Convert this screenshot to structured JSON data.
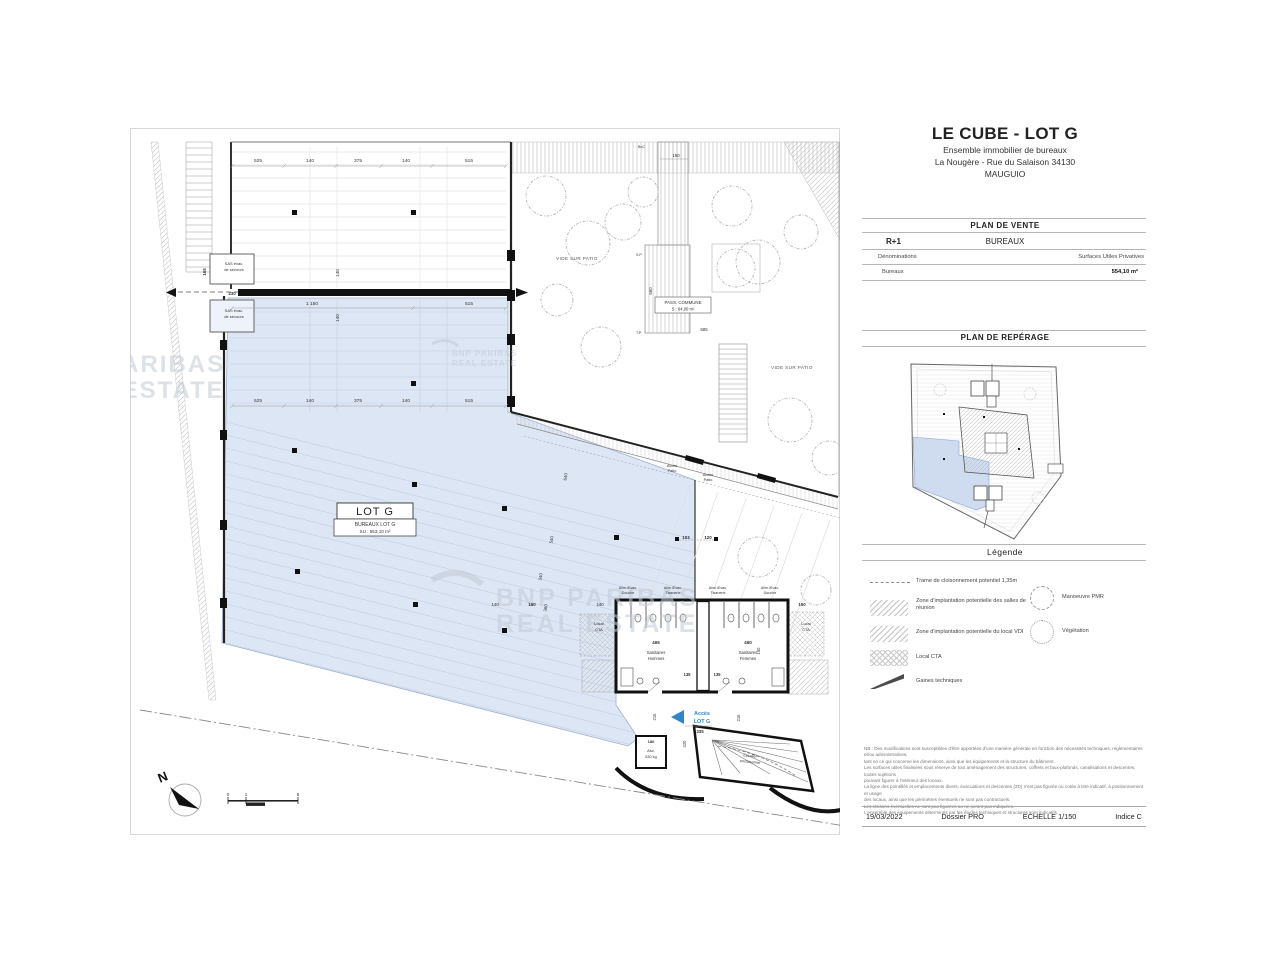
{
  "header": {
    "title": "LE CUBE - LOT G",
    "line1": "Ensemble immobilier de bureaux",
    "line2": "La Nougère - Rue du Salaison 34130",
    "line3": "MAUGUIO"
  },
  "vente": {
    "title": "PLAN DE VENTE",
    "level": "R+1",
    "usage": "BUREAUX",
    "col_name": "Dénominations",
    "col_surface": "Surfaces Utiles Privatives",
    "row_name": "Bureaux",
    "row_surface": "554,10 m²"
  },
  "reperage": {
    "title": "PLAN DE REPÉRAGE"
  },
  "legende": {
    "title": "Légende",
    "item1": "Trame de cloisonnement potentiel 1,35m",
    "item2": "Zone d'implantation potentielle des salles de réunion",
    "item3": "Zone d'implantation potentielle du local VDI",
    "item4": "Local CTA",
    "item5": "Gaines techniques",
    "pmr": "Manoeuvre PMR",
    "vegetation": "Végétation"
  },
  "disclaimer": [
    "NB : Des modifications sont susceptibles d'être apportées d'une manière générale en fonction des nécessités techniques, réglementaires et/ou administratives,",
    "tant en ce qui concerne les dimensions, ainsi que les équipements et la structure du bâtiment.",
    "Les surfaces utiles finalisées sous réserve de tout aménagement des structures, coffrets et faux-plafonds, canalisations et descentes, toutes sujétions",
    "pouvant figurer à l'intérieur des locaux.",
    "La ligne des pointillés et emplacements divers, évacuations et descentes (2D) n'est pas figurée ou cotée à titre indicatif, à positionnement et usage",
    "des locaux, ainsi que les périmètres éventuels ne sont pas contractuels.",
    "Les cloisons éventuelles ne sont pas figurées ou ne seront pas indiquées.",
    "L'ensemble des équipements déterminés par les études techniques et structures sont indicatifs."
  ],
  "footer": {
    "date": "19/03/2022",
    "dossier": "Dossier PRO",
    "echelle": "ECHELLE 1/150",
    "indice": "Indice C"
  },
  "plan": {
    "lot_box": {
      "title": "LOT G",
      "subtitle": "BUREAUX LOT G",
      "surface": "SU : 553,10 m²"
    },
    "dims": {
      "top": [
        "525",
        "140",
        "375",
        "140",
        "515"
      ],
      "mid": [
        "525",
        "140",
        "375",
        "140",
        "515"
      ],
      "wall": [
        "1 150",
        "515"
      ],
      "v140a": "140",
      "v140b": "140",
      "sas_w": "230",
      "sas_h": "165",
      "pass_w": "190",
      "pass_h": "660",
      "pass_b": "685",
      "inner": [
        "640",
        "540",
        "340",
        "360"
      ],
      "door_a": "103",
      "door_b": "120",
      "wc_top": [
        "140",
        "160",
        "140",
        "150"
      ],
      "wc_135a": "135",
      "wc_135b": "135",
      "wc_150": "150",
      "e216a": "216",
      "e216b": "216",
      "e335": "335",
      "e420": "420"
    },
    "labels": {
      "sas1": "SAS évac.",
      "sas2": "de secours",
      "pass1": "PASS. COMMUNE",
      "pass2": "S : 64,00 m²",
      "patio": "VIDE SUR PATIO",
      "acces1": "Accès",
      "acces2": "Patio",
      "alim_a1": "Alim./Evac.",
      "alim_a2": "Douche",
      "alim_b1": "Alim./Evac.",
      "alim_b2": "Tisanerie",
      "alim_c1": "Alim./Evac.",
      "alim_c2": "Tisanerie",
      "alim_d1": "Alim./Evac.",
      "alim_d2": "Douche",
      "cta1": "Local",
      "cta2": "CTA",
      "sp": "S.P.",
      "tp": "T.P.",
      "bvc": "BvC",
      "north": "N"
    },
    "wc": {
      "h_num": "465",
      "h_l1": "Sanitaires",
      "h_l2": "Hommes",
      "f_num": "460",
      "f_l1": "Sanitaires",
      "f_l2": "Femmes"
    },
    "entry": {
      "acces": "Accès",
      "lot": "LOT G"
    },
    "asc": {
      "d180": "180",
      "l1": "Asc.",
      "l2": "630 kg"
    },
    "stair": {
      "l1": "Escalier",
      "l2": "encloisonné"
    },
    "scalebar": [
      "0",
      "1",
      "5"
    ],
    "watermark": {
      "line1": "BNP PARIBAS",
      "line2": "REAL ESTATE"
    }
  },
  "colors": {
    "lot_fill": "#dde6f4",
    "accent_blue": "#2f86c8",
    "watermark": "#c2cad6"
  }
}
